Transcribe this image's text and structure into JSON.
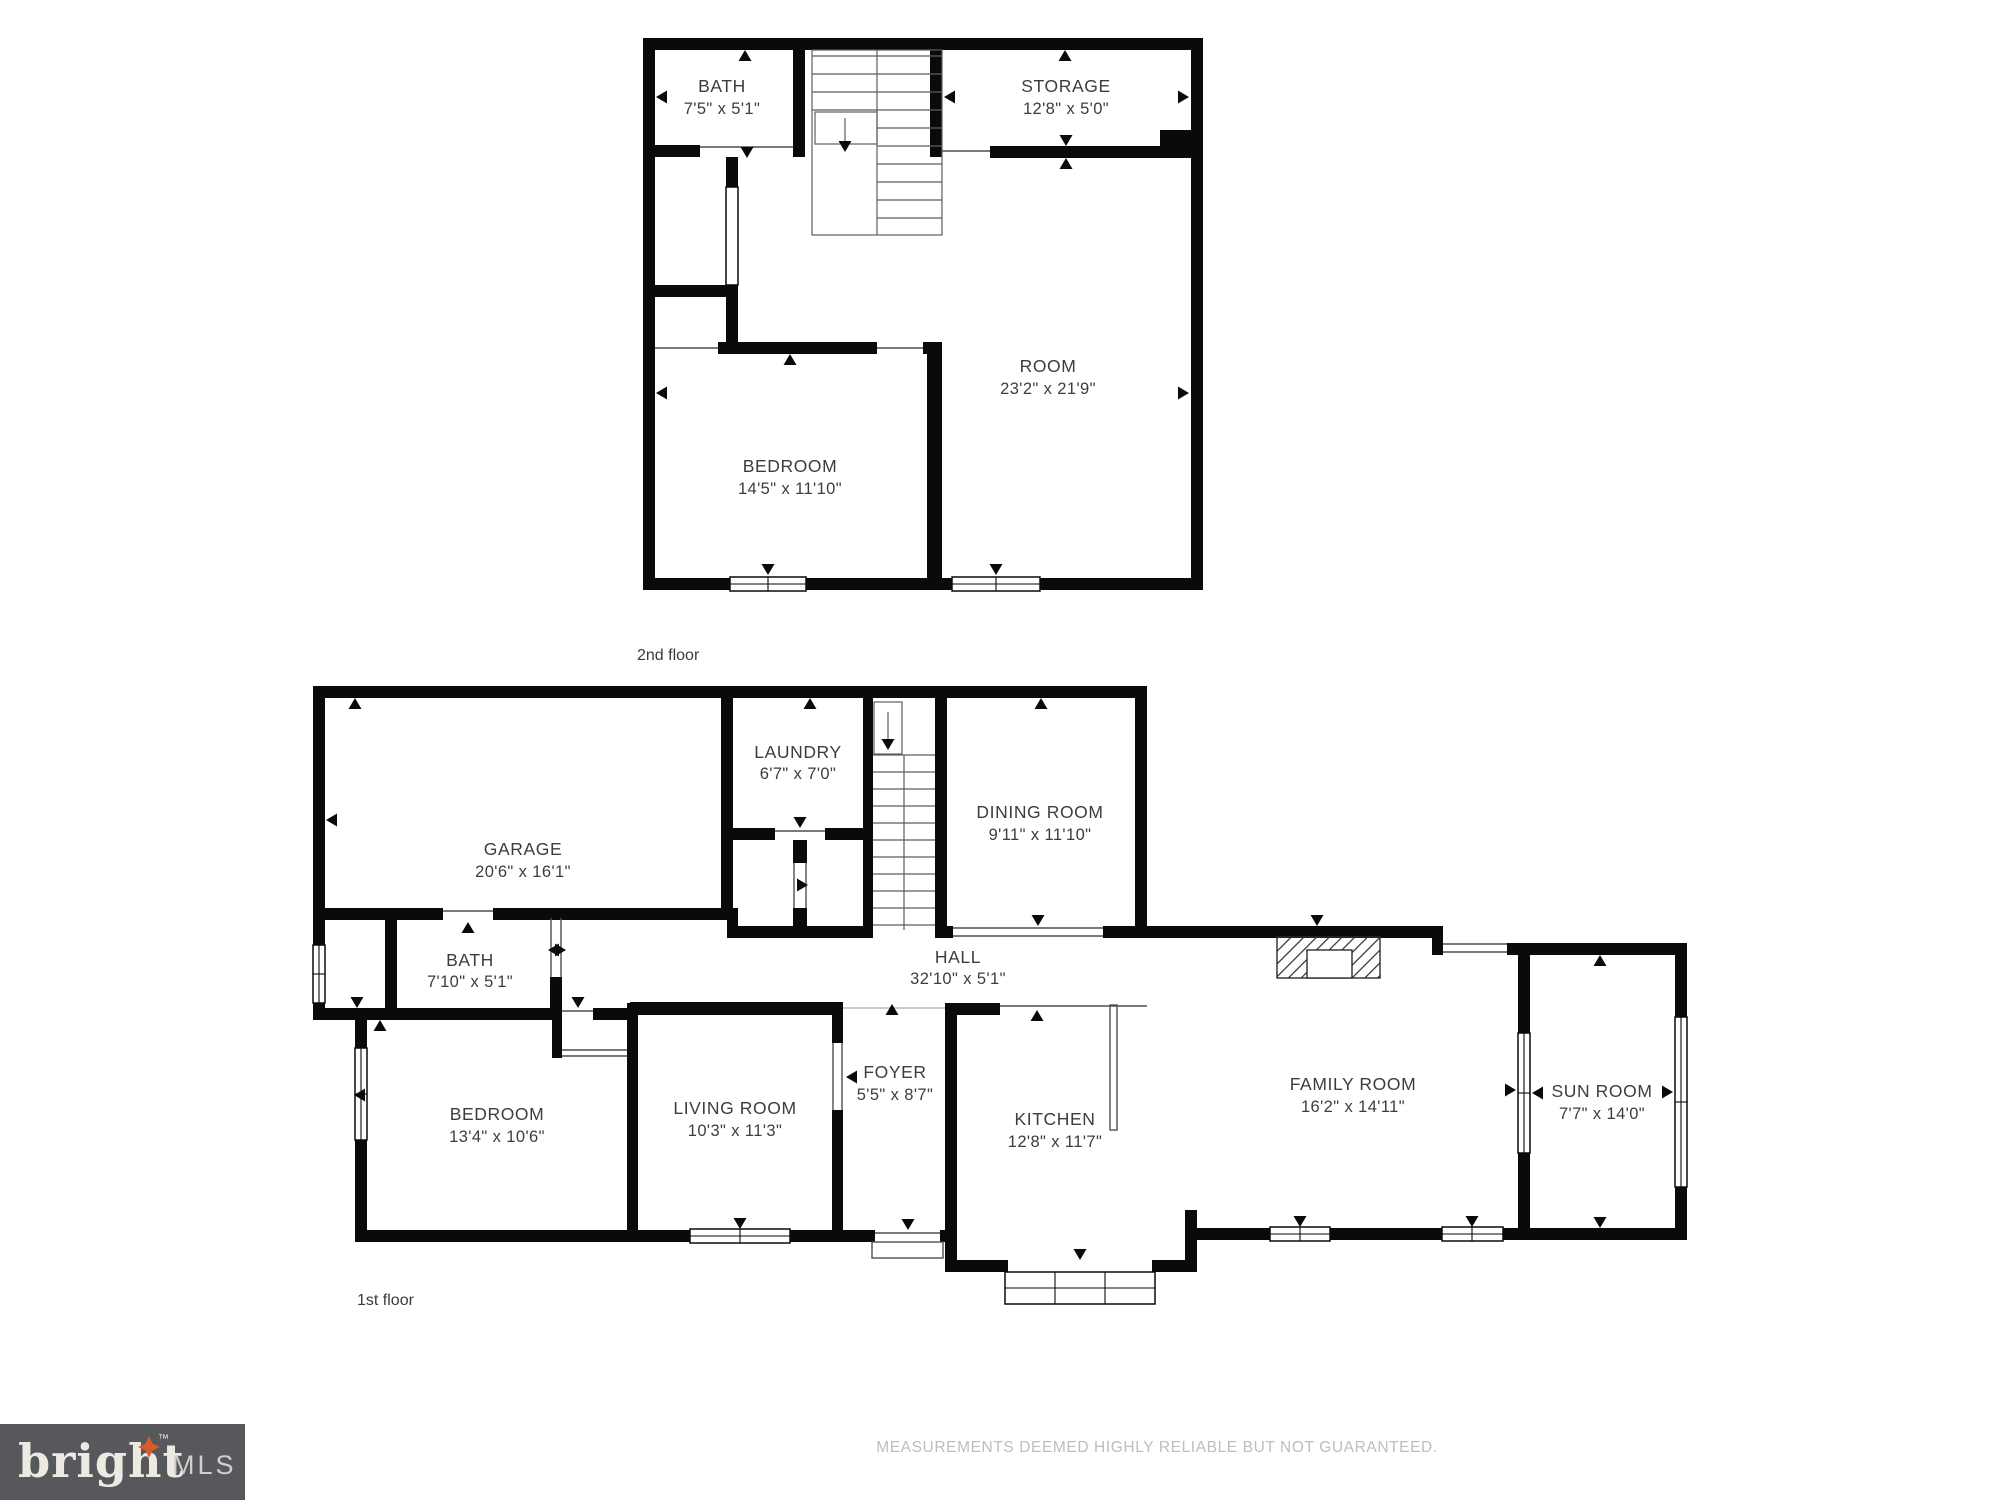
{
  "floors": [
    {
      "caption": "2nd floor",
      "rooms": [
        {
          "name": "BATH",
          "dims": "7'5\" x 5'1\""
        },
        {
          "name": "STORAGE",
          "dims": "12'8\" x 5'0\""
        },
        {
          "name": "ROOM",
          "dims": "23'2\" x 21'9\""
        },
        {
          "name": "BEDROOM",
          "dims": "14'5\" x 11'10\""
        }
      ]
    },
    {
      "caption": "1st floor",
      "rooms": [
        {
          "name": "GARAGE",
          "dims": "20'6\" x 16'1\""
        },
        {
          "name": "LAUNDRY",
          "dims": "6'7\" x 7'0\""
        },
        {
          "name": "DINING ROOM",
          "dims": "9'11\" x 11'10\""
        },
        {
          "name": "HALL",
          "dims": "32'10\" x 5'1\""
        },
        {
          "name": "BATH",
          "dims": "7'10\" x 5'1\""
        },
        {
          "name": "BEDROOM",
          "dims": "13'4\" x 10'6\""
        },
        {
          "name": "LIVING ROOM",
          "dims": "10'3\" x 11'3\""
        },
        {
          "name": "FOYER",
          "dims": "5'5\" x 8'7\""
        },
        {
          "name": "KITCHEN",
          "dims": "12'8\" x 11'7\""
        },
        {
          "name": "FAMILY ROOM",
          "dims": "16'2\" x 14'11\""
        },
        {
          "name": "SUN ROOM",
          "dims": "7'7\" x 14'0\""
        }
      ]
    }
  ],
  "footer": {
    "brand": {
      "word": "bright",
      "tm": "™",
      "suffix": "MLS"
    },
    "disclaimer": "MEASUREMENTS DEEMED HIGHLY RELIABLE BUT NOT GUARANTEED."
  },
  "colors": {
    "wall": "#0a0a0a",
    "thin_line": "#4f4f4f",
    "label": "#3d3d3d",
    "logo_background": "#57585b",
    "logo_word": "#edeae4",
    "logo_star": "#d85b2a",
    "logo_suffix": "#cfcfcd",
    "disclaimer": "#bdbdbd",
    "background": "#ffffff"
  }
}
